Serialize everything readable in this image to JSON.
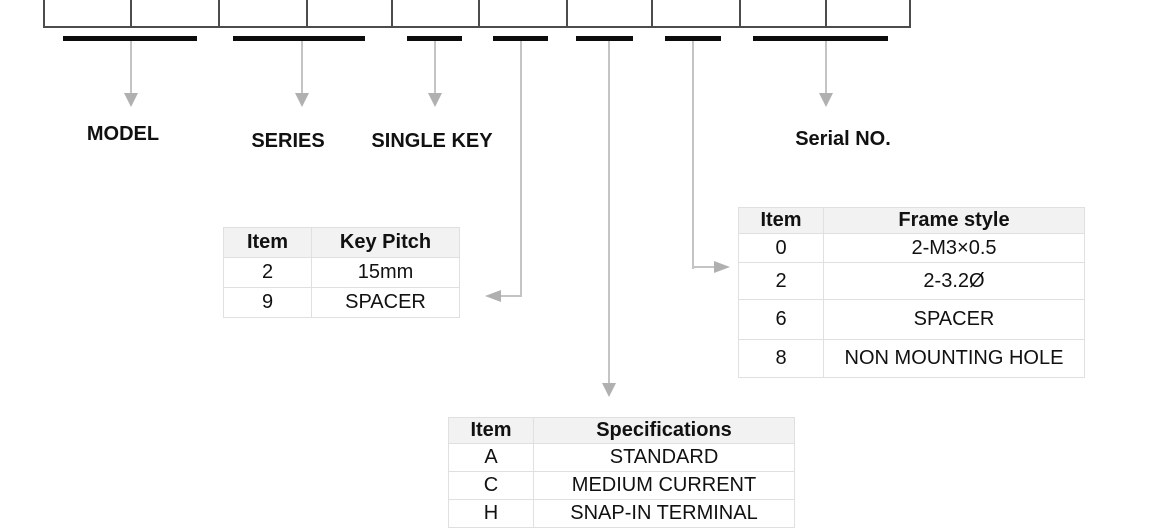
{
  "colors": {
    "box_border": "#4c4c4c",
    "underline_bar": "#0c0c0c",
    "connector_line": "#c4c4c4",
    "arrowhead": "#b0b0b0",
    "table_border": "#e0e0e0",
    "table_header_bg": "#f2f2f2",
    "text": "#111111"
  },
  "part_number_boxes": {
    "cell_count": 10
  },
  "callouts": {
    "model": "MODEL",
    "series": "SERIES",
    "single_key": "SINGLE KEY",
    "serial_no": "Serial NO."
  },
  "tables": {
    "key_pitch": {
      "headers": [
        "Item",
        "Key Pitch"
      ],
      "rows": [
        [
          "2",
          "15mm"
        ],
        [
          "9",
          "SPACER"
        ]
      ]
    },
    "frame_style": {
      "headers": [
        "Item",
        "Frame style"
      ],
      "rows": [
        [
          "0",
          "2-M3×0.5"
        ],
        [
          "2",
          "2-3.2Ø"
        ],
        [
          "6",
          "SPACER"
        ],
        [
          "8",
          "NON MOUNTING HOLE"
        ]
      ]
    },
    "specifications": {
      "headers": [
        "Item",
        "Specifications"
      ],
      "rows": [
        [
          "A",
          "STANDARD"
        ],
        [
          "C",
          "MEDIUM CURRENT"
        ],
        [
          "H",
          "SNAP-IN TERMINAL"
        ]
      ]
    }
  }
}
